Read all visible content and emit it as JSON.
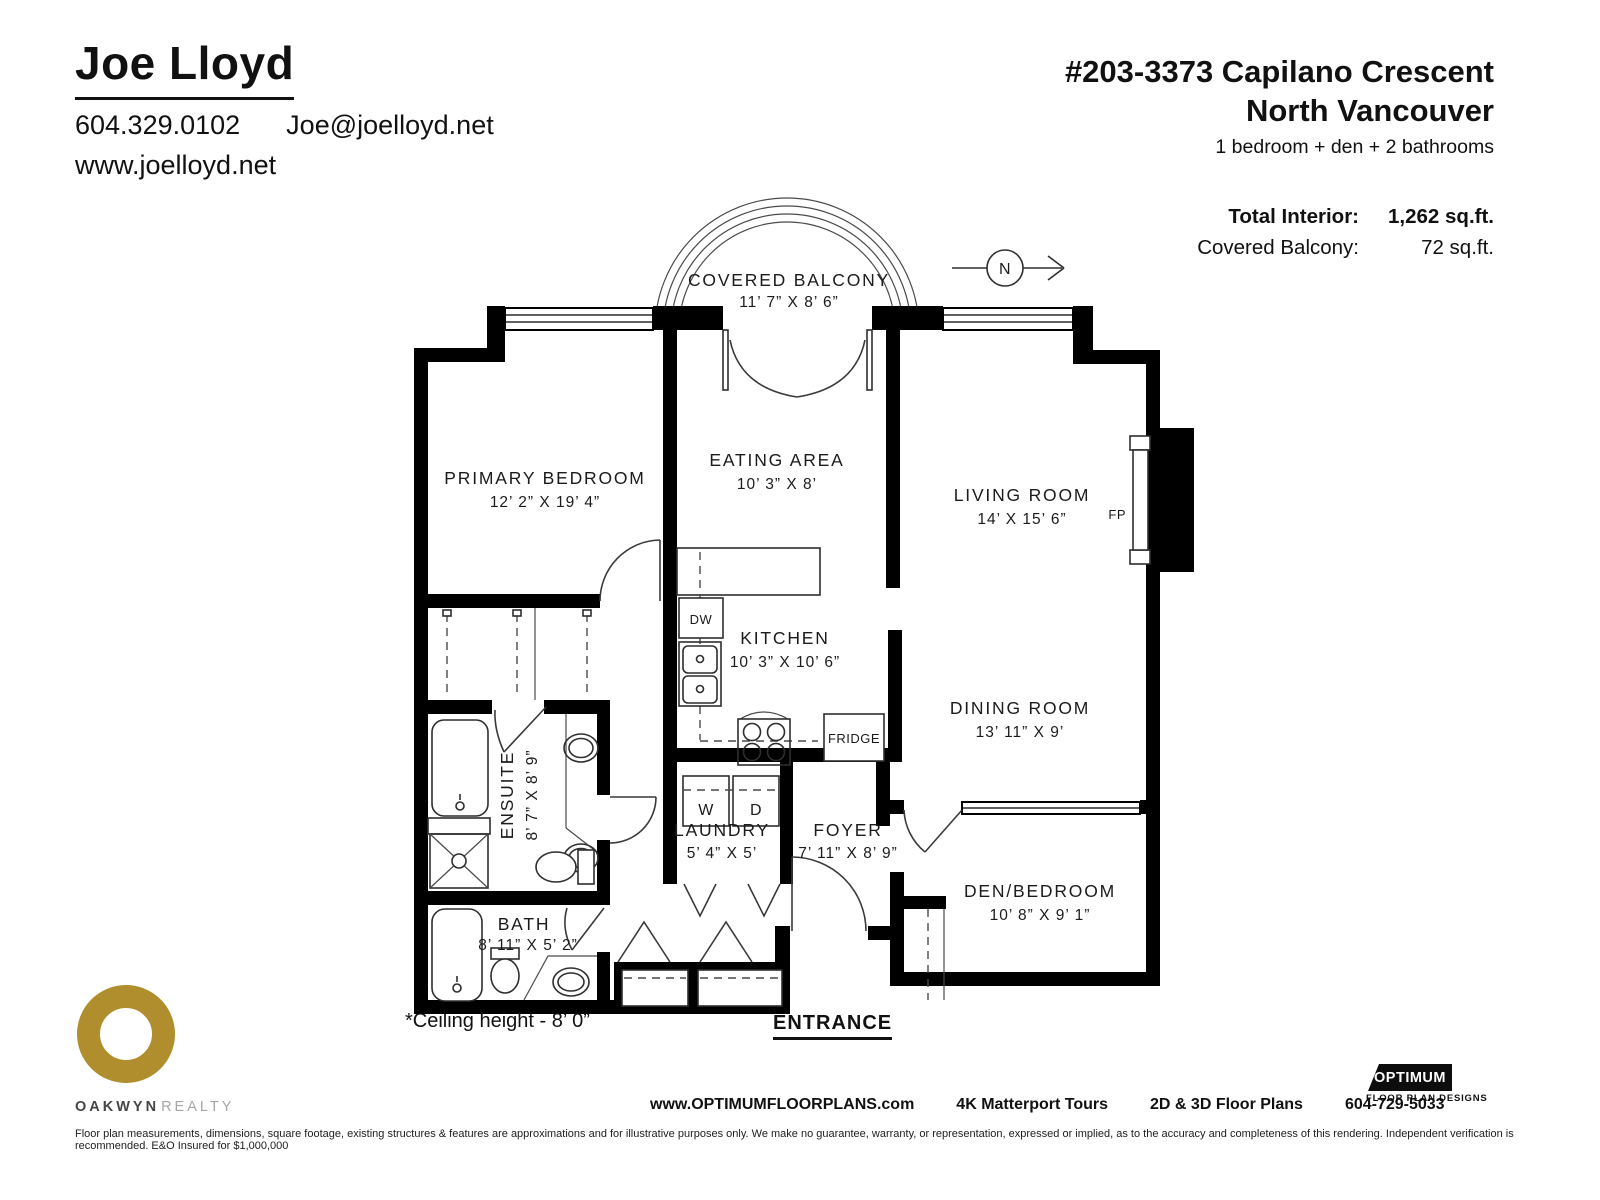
{
  "agent": {
    "name": "Joe Lloyd",
    "phone": "604.329.0102",
    "email": "Joe@joelloyd.net",
    "website": "www.joelloyd.net"
  },
  "listing": {
    "address_line1": "#203-3373 Capilano Crescent",
    "city": "North Vancouver",
    "summary": "1 bedroom + den + 2 bathrooms",
    "total_interior_label": "Total Interior:",
    "total_interior_value": "1,262 sq.ft.",
    "covered_balcony_label": "Covered Balcony:",
    "covered_balcony_value": "72 sq.ft."
  },
  "rooms": {
    "covered_balcony": {
      "name": "COVERED BALCONY",
      "dims": "11’ 7” X 8’ 6”"
    },
    "primary_bedroom": {
      "name": "PRIMARY BEDROOM",
      "dims": "12’ 2” X 19’ 4”"
    },
    "eating_area": {
      "name": "EATING AREA",
      "dims": "10’ 3” X 8’"
    },
    "living_room": {
      "name": "LIVING ROOM",
      "dims": "14’ X 15’ 6”"
    },
    "kitchen": {
      "name": "KITCHEN",
      "dims": "10’ 3” X 10’ 6”"
    },
    "dining_room": {
      "name": "DINING ROOM",
      "dims": "13’ 11” X 9’"
    },
    "ensuite": {
      "name": "ENSUITE",
      "dims": "8’ 7” X 8’ 9”"
    },
    "laundry": {
      "name": "LAUNDRY",
      "dims": "5’ 4” X 5’"
    },
    "foyer": {
      "name": "FOYER",
      "dims": "7’ 11” X 8’ 9”"
    },
    "bath": {
      "name": "BATH",
      "dims": "8’ 11” X 5’ 2”"
    },
    "den_bedroom": {
      "name": "DEN/BEDROOM",
      "dims": "10’ 8” X 9’ 1”"
    }
  },
  "appliances": {
    "dishwasher": "DW",
    "fridge": "FRIDGE",
    "washer": "W",
    "dryer": "D",
    "fireplace": "FP"
  },
  "compass": {
    "north": "N"
  },
  "notes": {
    "ceiling": "*Ceiling height - 8’ 0”",
    "entrance": "ENTRANCE"
  },
  "footer": {
    "brokerage_name": "OAKWYN",
    "brokerage_suffix": "REALTY",
    "website": "www.OPTIMUMFLOORPLANS.com",
    "tours": "4K Matterport Tours",
    "plans": "2D & 3D Floor Plans",
    "phone": "604-729-5033",
    "logo_title": "OPTIMUM",
    "logo_subtitle": "FLOOR PLAN DESIGNS",
    "disclaimer": "Floor plan measurements, dimensions, square footage, existing structures & features are approximations and for illustrative purposes only. We make no guarantee, warranty, or representation, expressed or implied, as to the accuracy and completeness of this rendering. Independent verification is recommended. E&O Insured for $1,000,000"
  },
  "colors": {
    "wall": "#000000",
    "accent_gold": "#b08e2e"
  }
}
